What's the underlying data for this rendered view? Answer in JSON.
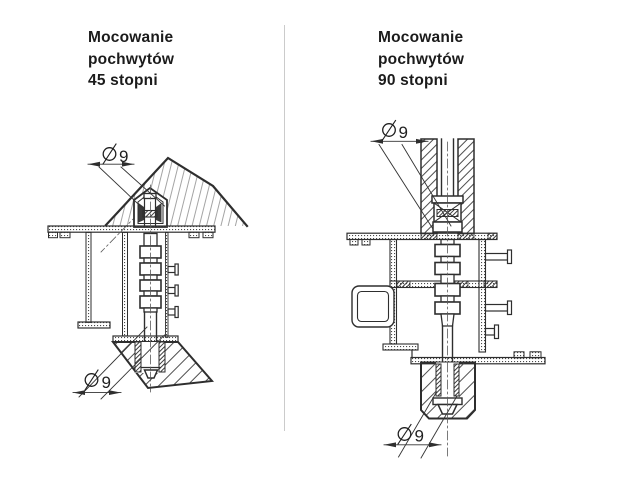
{
  "sheet": {
    "background": "#ffffff",
    "divider_color": "#cbcbcb",
    "ink_color": "#2e2e2e",
    "text_color": "#1b1b1b"
  },
  "left_section": {
    "title": {
      "line1": "Mocowanie",
      "line2": "pochwytów",
      "line3": "45 stopni"
    },
    "dimensions": {
      "top": {
        "symbol": "⌀",
        "value": "9",
        "label": "⌀9"
      },
      "bottom": {
        "symbol": "⌀",
        "value": "9",
        "label": "⌀9"
      }
    }
  },
  "right_section": {
    "title": {
      "line1": "Mocowanie",
      "line2": "pochwytów",
      "line3": "90 stopni"
    },
    "dimensions": {
      "top": {
        "symbol": "⌀",
        "value": "9",
        "label": "⌀9"
      },
      "bottom": {
        "symbol": "⌀",
        "value": "9",
        "label": "⌀9"
      }
    }
  }
}
